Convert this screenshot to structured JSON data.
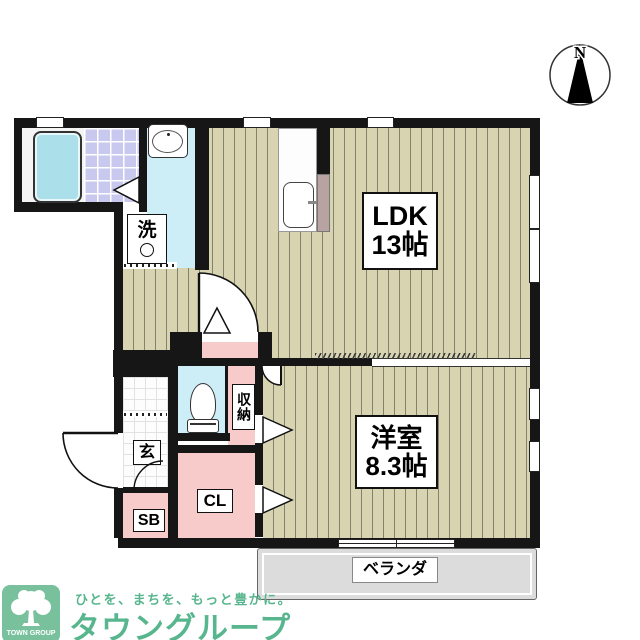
{
  "plan": {
    "compass_label": "N",
    "rooms": {
      "ldk": {
        "name": "LDK",
        "size": "13帖"
      },
      "western_room": {
        "name": "洋室",
        "size": "8.3帖"
      },
      "laundry": {
        "label": "洗"
      },
      "entrance": {
        "label": "玄"
      },
      "shoe_box": {
        "label": "SB"
      },
      "closet": {
        "label": "CL"
      },
      "storage": {
        "label": "収納"
      },
      "veranda": {
        "label": "ベランダ"
      }
    }
  },
  "branding": {
    "tagline": "ひとを、まちを、もっと豊かに。",
    "company_jp": "タウングループ",
    "company_en": "TOWN GROUP"
  },
  "colors": {
    "wall": "#161616",
    "wood_floor": "#d8d4b2",
    "bath_tile": "#c9c9ef",
    "water_floor": "#cdeef7",
    "closet_pink": "#f8cbcb",
    "kitchen_side": "#b9a2a2",
    "veranda_gray": "#dcdcdc",
    "brand_green": "#57b68e",
    "logo_bg": "#79c19c"
  }
}
